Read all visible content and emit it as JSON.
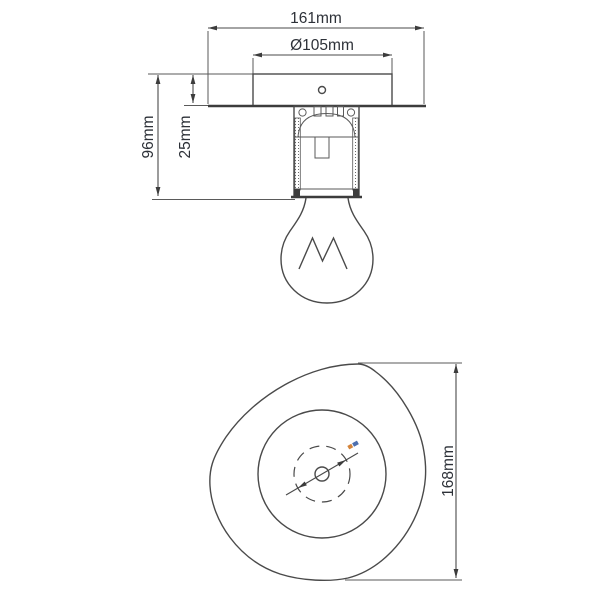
{
  "front_view": {
    "overall_width_label": "161mm",
    "canopy_diameter_label": "Ø105mm",
    "overall_height_label": "96mm",
    "canopy_height_label": "25mm"
  },
  "bottom_view": {
    "overall_height_label": "168mm"
  },
  "colors": {
    "background": "#ffffff",
    "line": "#4a4a4a",
    "dimension_text": "#2d3138",
    "tiny_label_orange": "#d4843a",
    "tiny_label_blue": "#4d6fae"
  }
}
